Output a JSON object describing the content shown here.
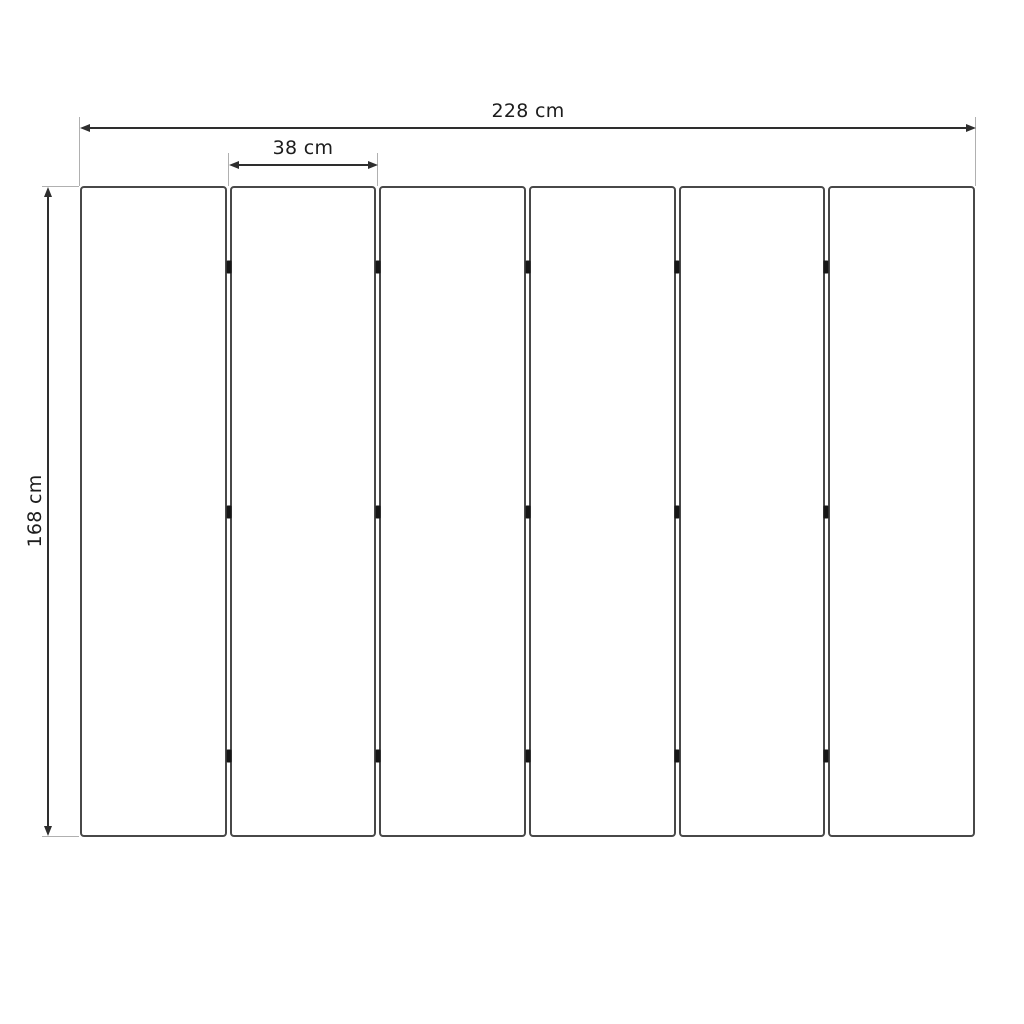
{
  "diagram": {
    "panel_count": 6,
    "hinge_joint_count": 5,
    "hinge_positions_pct": [
      12.5,
      50,
      87.5
    ],
    "dimensions": {
      "total_width_label": "228 cm",
      "panel_width_label": "38 cm",
      "height_label": "168 cm"
    },
    "colors": {
      "background": "#ffffff",
      "panel_border": "#484848",
      "dimension_line": "#2e2e2e",
      "extension_line": "#b0b0b0",
      "hinge": "#161616",
      "text": "#1c1c1c"
    }
  }
}
